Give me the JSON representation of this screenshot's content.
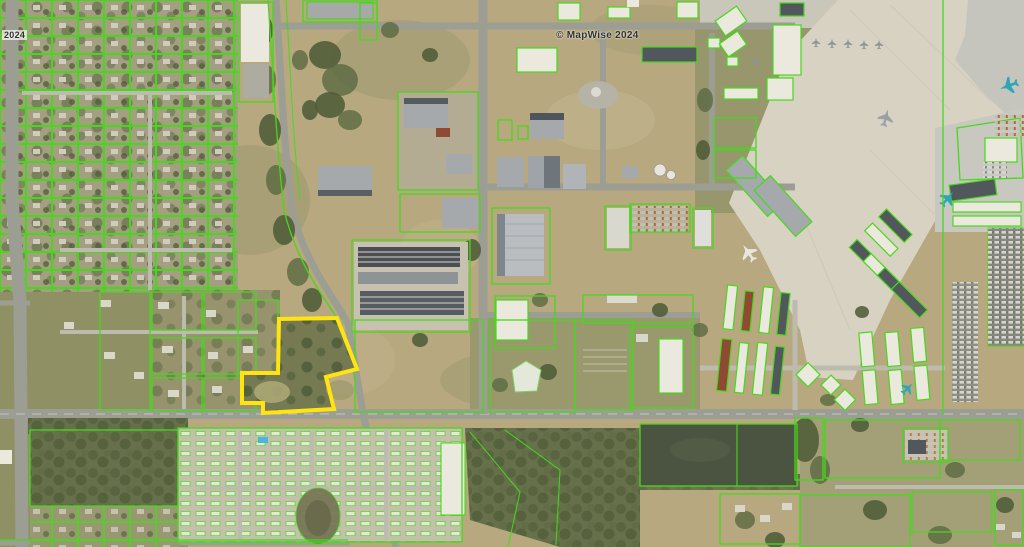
{
  "watermark": {
    "text": "© MapWise 2024"
  },
  "corner_watermark": {
    "text": "2024"
  },
  "subject_parcel": {
    "points": "279,319 337,318 357,369 326,377 334,409 263,413 263,403 242,403 242,373 278,373"
  },
  "palette": {
    "parcel-green": "#46d91a",
    "subject-yellow": "#ffe412",
    "field-tan": "#b7a87f",
    "field-olive": "#95946a",
    "tree-dark": "#4e5c38",
    "road-gray": "#9c9d93",
    "concrete": "#d8d2c2",
    "water-dark": "#4a5440",
    "pool-blue": "#49b6e0",
    "building-white": "#ebe9dd",
    "building-gray": "#a5a9ac",
    "building-dark": "#51575c",
    "plane-teal": "#2fa6b5",
    "watermark-gray": "#2e2e2e"
  }
}
